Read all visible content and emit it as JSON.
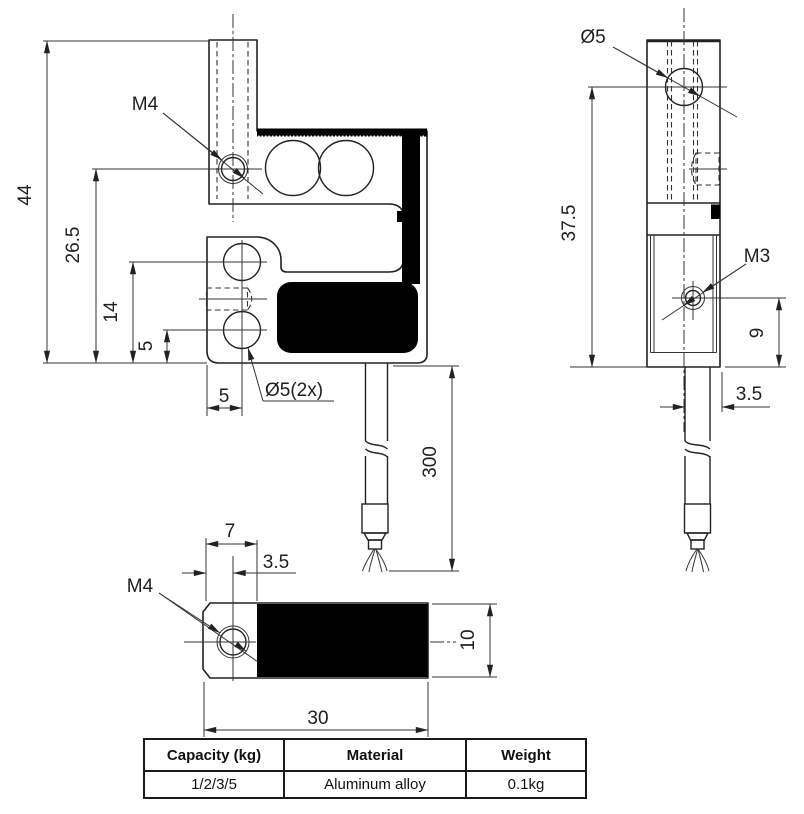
{
  "drawing": {
    "colors": {
      "line": "#222222",
      "fill_black": "#000000",
      "background": "#ffffff"
    },
    "front_view": {
      "thread_label": "M4",
      "holes_label": "Ø5(2x)",
      "dim_total_height": "44",
      "dim_m4_height": "26.5",
      "dim_upper_hole_height": "14",
      "dim_lower_hole_height": "5",
      "dim_hole_offset": "5",
      "dim_cable_length": "300"
    },
    "side_view": {
      "hole_label": "Ø5",
      "thread_label": "M3",
      "dim_height": "37.5",
      "dim_m3_height": "9",
      "dim_cable_offset": "3.5"
    },
    "bottom_view": {
      "thread_label": "M4",
      "dim_end_length": "7",
      "dim_hole_offset": "3.5",
      "dim_width": "10",
      "dim_length": "30"
    },
    "table": {
      "headers": [
        "Capacity (kg)",
        "Material",
        "Weight"
      ],
      "rows": [
        [
          "1/2/3/5",
          "Aluminum alloy",
          "0.1kg"
        ]
      ]
    }
  }
}
